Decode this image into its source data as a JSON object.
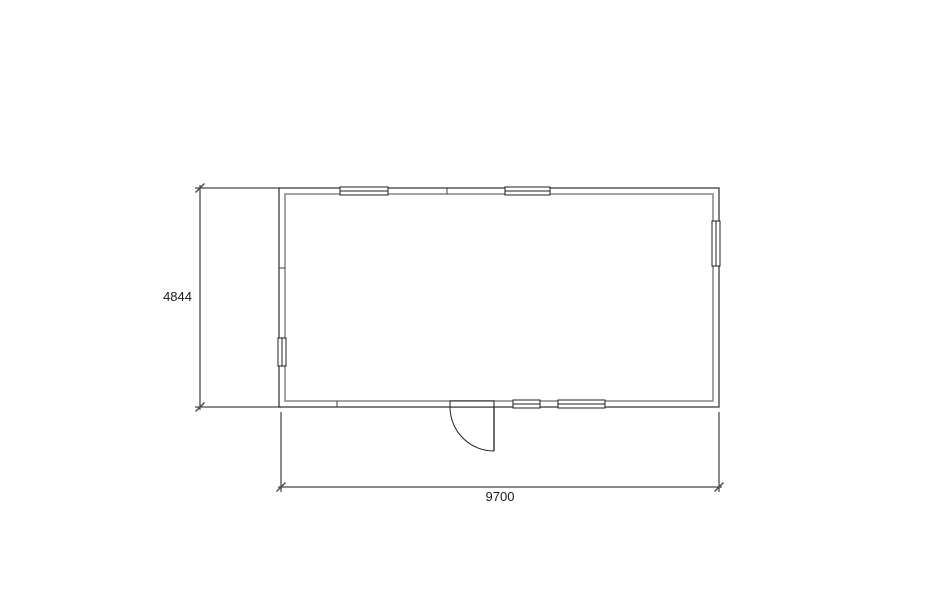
{
  "drawing": {
    "type": "floor-plan",
    "room": {
      "width_value": "9700",
      "height_value": "4844",
      "rect_px": {
        "x": 279,
        "y": 188,
        "w": 440,
        "h": 219
      },
      "wall_thickness_px": 6
    },
    "colors": {
      "wall_outer": "#3d3d3d",
      "wall_inner": "#999999",
      "opening": "#1f1f1f",
      "dimension": "#1a1a1a",
      "tick": "#4a4a4a",
      "text": "#1a1a1a",
      "background": "#ffffff"
    },
    "windows": [
      {
        "wall": "top",
        "from": 340,
        "to": 388
      },
      {
        "wall": "top",
        "from": 505,
        "to": 550
      },
      {
        "wall": "right",
        "from": 221,
        "to": 266
      },
      {
        "wall": "left",
        "from": 338,
        "to": 366
      },
      {
        "wall": "bottom",
        "from": 513,
        "to": 540
      },
      {
        "wall": "bottom",
        "from": 558,
        "to": 605
      }
    ],
    "door": {
      "wall": "bottom",
      "from": 450,
      "to": 494,
      "hinge": "right",
      "swing": "out",
      "radius": 44
    },
    "joints": [
      {
        "wall": "top",
        "at": 447
      },
      {
        "wall": "bottom",
        "at": 337
      },
      {
        "wall": "left",
        "at": 268
      }
    ],
    "dimensions": [
      {
        "label": "4844",
        "orientation": "vertical",
        "line_x": 200,
        "span": [
          188,
          407
        ],
        "extensions": [
          {
            "y": 188,
            "x1": 195,
            "x2": 279
          },
          {
            "y": 407,
            "x1": 195,
            "x2": 281
          }
        ]
      },
      {
        "label": "9700",
        "orientation": "horizontal",
        "line_y": 487,
        "span": [
          281,
          719
        ],
        "extensions": [
          {
            "x": 281,
            "y1": 412,
            "y2": 492
          },
          {
            "x": 719,
            "y1": 412,
            "y2": 492
          }
        ]
      }
    ]
  }
}
